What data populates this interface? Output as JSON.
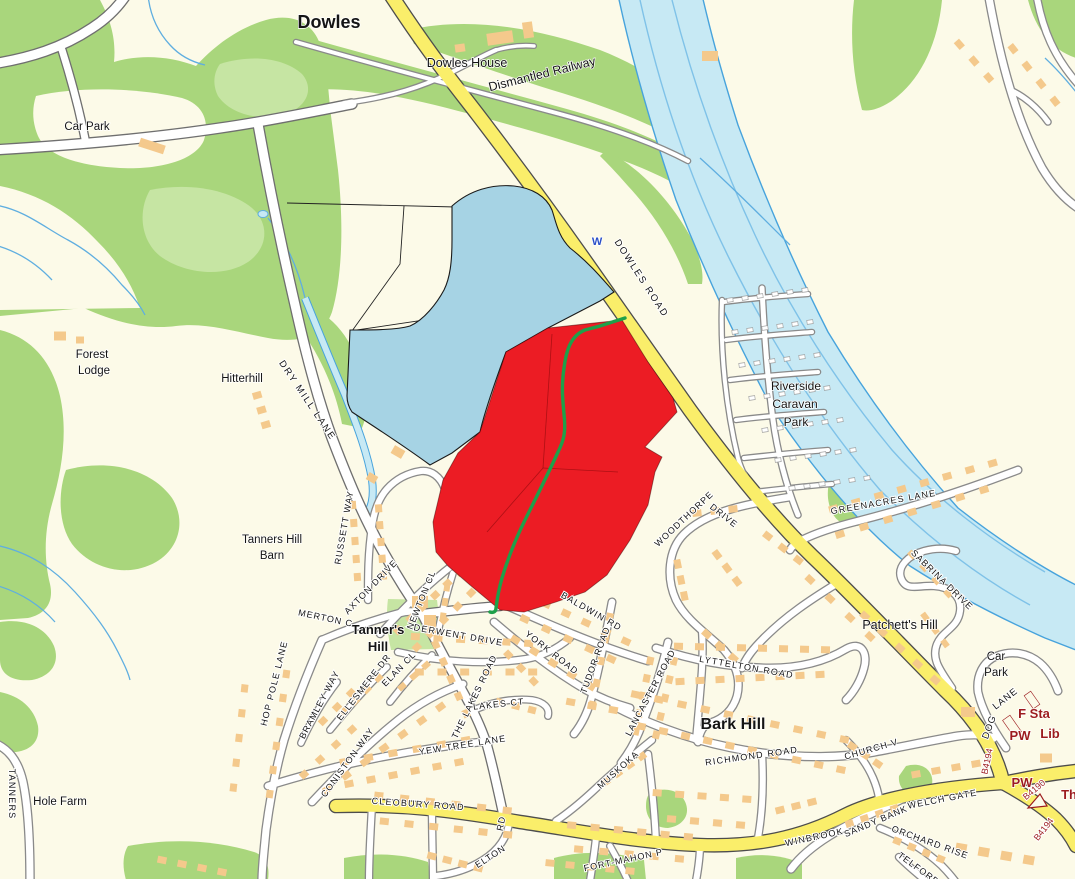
{
  "colors": {
    "background": "#FCFAE8",
    "woodland": "#A9D67C",
    "woodland_light": "#C6E5A3",
    "building": "#F4C98C",
    "road_yellow": "#FAEE6A",
    "road_casing_yellow": "#4D4D4D",
    "road_white": "#FFFFFF",
    "road_casing": "#8A8A8A",
    "river_fill": "#C7E9F4",
    "river_edge": "#47A3DC",
    "stream": "#5FAEE0",
    "site_red": "#EC1C24",
    "site_blue": "#A6D3E4",
    "footpath_green": "#1FA04A",
    "text_black": "#141414",
    "text_maroon": "#9C1B1E",
    "text_blue": "#2B50C8"
  },
  "overlays": {
    "red_site": "red highlighted land parcel",
    "blue_site": "light-blue highlighted land parcel",
    "green_line": "footpath through red parcel"
  },
  "labels": [
    {
      "t": "Dowles",
      "x": 329,
      "y": 28,
      "s": 18,
      "b": 1
    },
    {
      "t": "Dowles House",
      "x": 467,
      "y": 67,
      "s": 12.5
    },
    {
      "t": "Dismantled Railway",
      "x": 543,
      "y": 78,
      "s": 12.5,
      "r": -14
    },
    {
      "t": "Car Park",
      "x": 87,
      "y": 130,
      "s": 11.5
    },
    {
      "t": "Forest",
      "x": 92,
      "y": 358,
      "s": 11.5
    },
    {
      "t": "Lodge",
      "x": 94,
      "y": 374,
      "s": 11.5
    },
    {
      "t": "Hitterhill",
      "x": 242,
      "y": 382,
      "s": 11.5
    },
    {
      "t": "DRY MILL LANE",
      "x": 305,
      "y": 402,
      "s": 9.5,
      "r": 56,
      "sp": 1.8,
      "st": 1
    },
    {
      "t": "DOWLES ROAD",
      "x": 639,
      "y": 280,
      "s": 9.5,
      "r": 57,
      "sp": 1.8,
      "st": 1
    },
    {
      "t": "W",
      "x": 597,
      "y": 245,
      "s": 11,
      "b": 1,
      "c": "#2B50C8"
    },
    {
      "t": "Riverside",
      "x": 796,
      "y": 390,
      "s": 12
    },
    {
      "t": "Caravan",
      "x": 795,
      "y": 408,
      "s": 12
    },
    {
      "t": "Park",
      "x": 796,
      "y": 426,
      "s": 12
    },
    {
      "t": "GREENACRES LANE",
      "x": 884,
      "y": 505,
      "s": 9,
      "r": -10,
      "sp": 1.2,
      "st": 1
    },
    {
      "t": "Tanners Hill",
      "x": 272,
      "y": 543,
      "s": 11.5
    },
    {
      "t": "Barn",
      "x": 272,
      "y": 559,
      "s": 11.5
    },
    {
      "t": "Tanner's",
      "x": 378,
      "y": 634,
      "s": 13,
      "b": 1
    },
    {
      "t": "Hill",
      "x": 378,
      "y": 651,
      "s": 13,
      "b": 1
    },
    {
      "t": "RUSSETT WAY",
      "x": 347,
      "y": 528,
      "s": 9,
      "r": -80,
      "sp": 1,
      "st": 1
    },
    {
      "t": "AXTON DRIVE",
      "x": 373,
      "y": 589,
      "s": 9,
      "r": -46,
      "sp": 1,
      "st": 1
    },
    {
      "t": "MERTON C",
      "x": 325,
      "y": 621,
      "s": 9,
      "r": 12,
      "sp": 1,
      "st": 1
    },
    {
      "t": "NEWTON CL",
      "x": 424,
      "y": 601,
      "s": 9,
      "r": -68,
      "sp": 1,
      "st": 1
    },
    {
      "t": "DERWENT DRIVE",
      "x": 458,
      "y": 638,
      "s": 9,
      "r": 10,
      "sp": 1.2,
      "st": 1
    },
    {
      "t": "ELAN CL",
      "x": 401,
      "y": 671,
      "s": 9,
      "r": -46,
      "sp": 1,
      "st": 1
    },
    {
      "t": "ELLESMERE DR",
      "x": 366,
      "y": 689,
      "s": 9,
      "r": -52,
      "sp": 1,
      "st": 1
    },
    {
      "t": "BRAMLEY WAY",
      "x": 322,
      "y": 706,
      "s": 9,
      "r": -62,
      "sp": 1,
      "st": 1
    },
    {
      "t": "CONISTON WAY",
      "x": 350,
      "y": 764,
      "s": 9,
      "r": -54,
      "sp": 1.2,
      "st": 1
    },
    {
      "t": "HOP POLE LANE",
      "x": 277,
      "y": 684,
      "s": 9,
      "r": -76,
      "sp": 1.2,
      "st": 1
    },
    {
      "t": "YEW TREE LANE",
      "x": 463,
      "y": 748,
      "s": 9,
      "r": -9,
      "sp": 1.2,
      "st": 1
    },
    {
      "t": "THE LAKES ROAD",
      "x": 477,
      "y": 698,
      "s": 9,
      "r": -64,
      "sp": 1,
      "st": 1
    },
    {
      "t": "LAKES CT",
      "x": 499,
      "y": 707,
      "s": 9,
      "r": -6,
      "sp": 1,
      "st": 1
    },
    {
      "t": "YORK ROAD",
      "x": 550,
      "y": 655,
      "s": 9,
      "r": 38,
      "sp": 1.2,
      "st": 1
    },
    {
      "t": "TUDOR ROAD",
      "x": 598,
      "y": 661,
      "s": 9,
      "r": -70,
      "sp": 1,
      "st": 1
    },
    {
      "t": "BALDWIN RD",
      "x": 590,
      "y": 614,
      "s": 9,
      "r": 30,
      "sp": 1.2,
      "st": 1
    },
    {
      "t": "LANCASTER ROAD",
      "x": 653,
      "y": 694,
      "s": 9,
      "r": -62,
      "sp": 1,
      "st": 1
    },
    {
      "t": "LYTTELTON ROAD",
      "x": 746,
      "y": 670,
      "s": 9,
      "r": 10,
      "sp": 1.2,
      "st": 1
    },
    {
      "t": "Bark Hill",
      "x": 733,
      "y": 729,
      "s": 16,
      "b": 1
    },
    {
      "t": "RICHMOND ROAD",
      "x": 752,
      "y": 759,
      "s": 9,
      "r": -8,
      "sp": 1.2,
      "st": 1
    },
    {
      "t": "CHURCH V",
      "x": 872,
      "y": 752,
      "s": 9,
      "r": -16,
      "sp": 1,
      "st": 1
    },
    {
      "t": "MUSKOKA",
      "x": 620,
      "y": 772,
      "s": 9,
      "r": -42,
      "sp": 1,
      "st": 1
    },
    {
      "t": "WOODTHORPE",
      "x": 686,
      "y": 521,
      "s": 9,
      "r": -43,
      "sp": 1,
      "st": 1
    },
    {
      "t": "DRIVE",
      "x": 722,
      "y": 518,
      "s": 9,
      "r": 38,
      "sp": 1,
      "st": 1
    },
    {
      "t": "SABRINA DRIVE",
      "x": 940,
      "y": 582,
      "s": 9,
      "r": 44,
      "sp": 1,
      "st": 1
    },
    {
      "t": "Patchett's Hill",
      "x": 900,
      "y": 629,
      "s": 12.5
    },
    {
      "t": "Car",
      "x": 996,
      "y": 660,
      "s": 11.5
    },
    {
      "t": "Park",
      "x": 996,
      "y": 676,
      "s": 11.5
    },
    {
      "t": "DOG",
      "x": 992,
      "y": 728,
      "s": 9.5,
      "r": -70,
      "sp": 1,
      "st": 1
    },
    {
      "t": "LANE",
      "x": 1007,
      "y": 701,
      "s": 9.5,
      "r": -38,
      "sp": 1,
      "st": 1
    },
    {
      "t": "F Sta",
      "x": 1034,
      "y": 718,
      "s": 13,
      "b": 1,
      "c": "#9C1B1E"
    },
    {
      "t": "PW",
      "x": 1020,
      "y": 740,
      "s": 13,
      "b": 1,
      "c": "#9C1B1E"
    },
    {
      "t": "Lib",
      "x": 1050,
      "y": 738,
      "s": 13,
      "b": 1,
      "c": "#9C1B1E"
    },
    {
      "t": "PW",
      "x": 1022,
      "y": 787,
      "s": 13,
      "b": 1,
      "c": "#9C1B1E"
    },
    {
      "t": "B4194",
      "x": 990,
      "y": 762,
      "s": 9,
      "r": -78,
      "c": "#9C1B1E",
      "st": 1
    },
    {
      "t": "B4190",
      "x": 1036,
      "y": 792,
      "s": 9,
      "r": -40,
      "c": "#9C1B1E",
      "st": 1
    },
    {
      "t": "B4194",
      "x": 1046,
      "y": 831,
      "s": 9,
      "r": -52,
      "c": "#9C1B1E",
      "st": 1
    },
    {
      "t": "Th",
      "x": 1069,
      "y": 799,
      "s": 13,
      "b": 1,
      "c": "#9C1B1E"
    },
    {
      "t": "WELCH GATE",
      "x": 943,
      "y": 802,
      "s": 9,
      "r": -11,
      "sp": 1.2,
      "st": 1
    },
    {
      "t": "SANDY BANK",
      "x": 877,
      "y": 824,
      "s": 9,
      "r": -23,
      "sp": 1,
      "st": 1
    },
    {
      "t": "ORCHARD RISE",
      "x": 929,
      "y": 845,
      "s": 9,
      "r": 20,
      "sp": 1,
      "st": 1
    },
    {
      "t": "TELFORD",
      "x": 917,
      "y": 871,
      "s": 9,
      "r": 36,
      "sp": 1,
      "st": 1
    },
    {
      "t": "WINBROOK",
      "x": 815,
      "y": 840,
      "s": 9,
      "r": -12,
      "sp": 1.2,
      "st": 1
    },
    {
      "t": "FORT-MAHON P",
      "x": 624,
      "y": 863,
      "s": 9,
      "r": -12,
      "sp": 1,
      "st": 1
    },
    {
      "t": "CLEOBURY ROAD",
      "x": 418,
      "y": 807,
      "s": 9,
      "r": 4,
      "sp": 1.2,
      "st": 1
    },
    {
      "t": "ELTON",
      "x": 492,
      "y": 859,
      "s": 9,
      "r": -33,
      "sp": 1,
      "st": 1
    },
    {
      "t": "RD",
      "x": 504,
      "y": 824,
      "s": 9,
      "r": -78,
      "sp": 1,
      "st": 1
    },
    {
      "t": "Hole Farm",
      "x": 60,
      "y": 805,
      "s": 11.5
    },
    {
      "t": "TANNERS",
      "x": 9,
      "y": 794,
      "s": 9,
      "r": 90,
      "sp": 1.2,
      "st": 1
    }
  ]
}
